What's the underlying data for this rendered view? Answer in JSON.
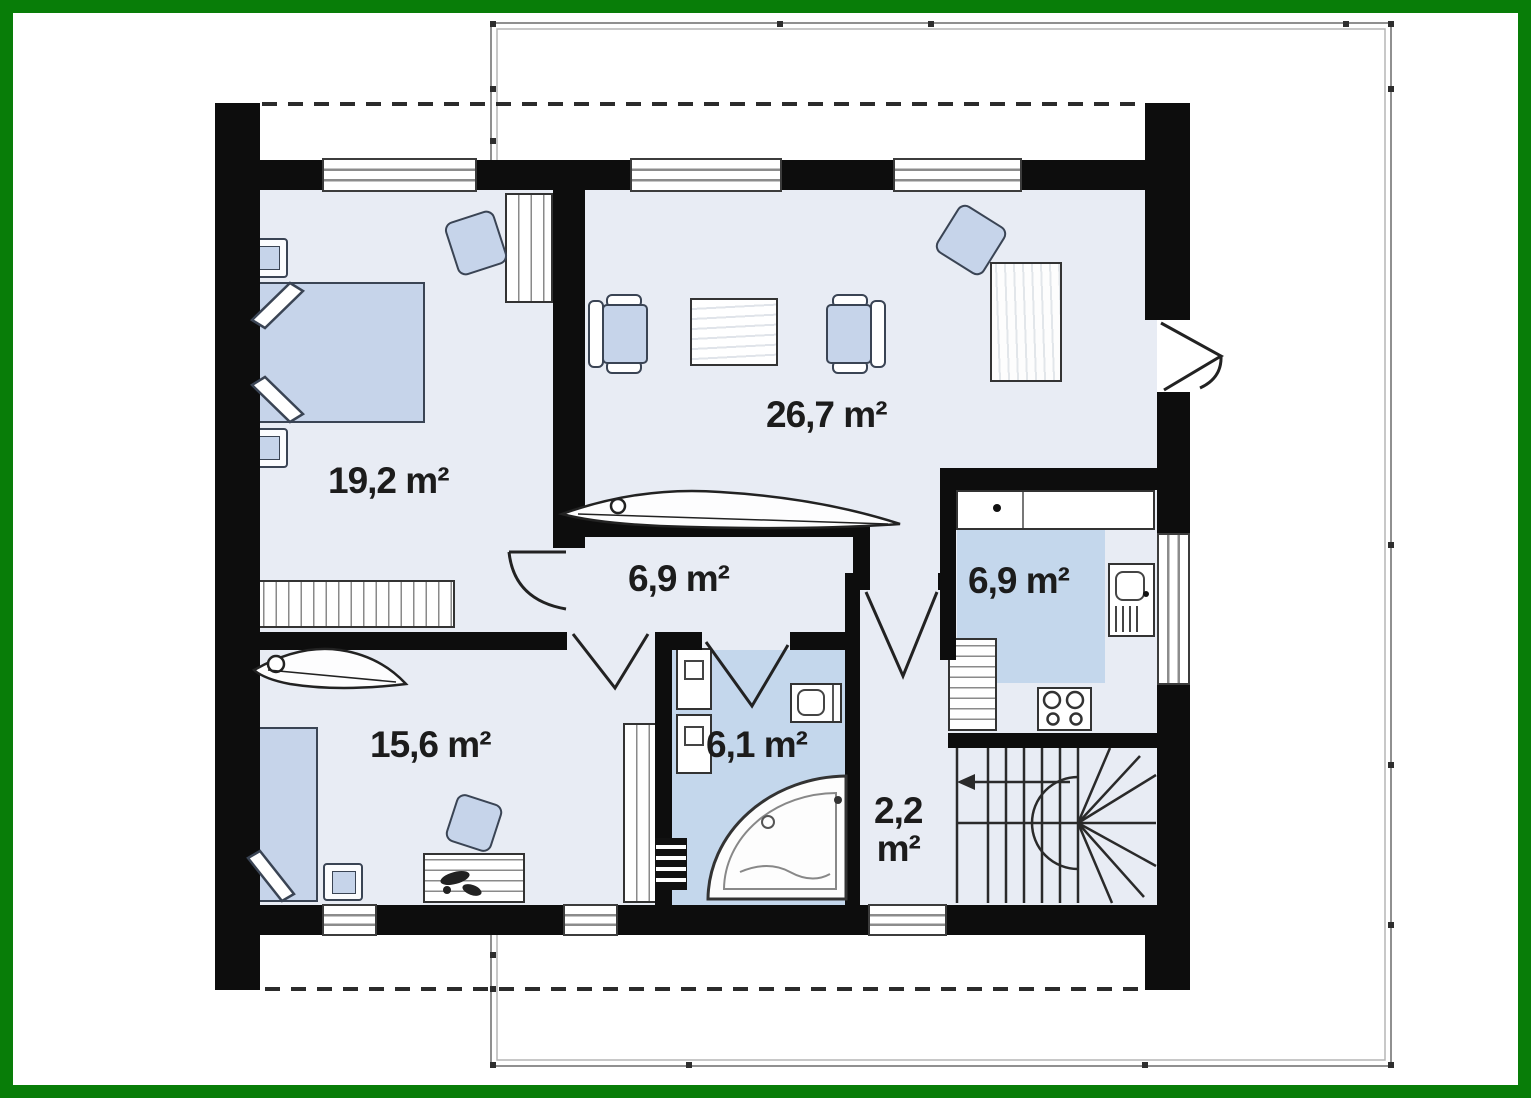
{
  "title": "first-floor plan",
  "frame": {
    "color": "#087d08"
  },
  "palette": {
    "wall": "#0d0d0d",
    "floor": "#e8ecf4",
    "wet_floor": "#c4d7ec",
    "furniture_fill": "#c6d4ea",
    "outline_stroke": "#3a4454"
  },
  "rooms": {
    "bedroom_main": {
      "area_label": "19,2 m²"
    },
    "living_room": {
      "area_label": "26,7 m²"
    },
    "hall": {
      "area_label": "6,9 m²"
    },
    "kitchen": {
      "area_label": "6,9 m²"
    },
    "bedroom_second": {
      "area_label": "15,6 m²"
    },
    "bathroom": {
      "area_label": "6,1 m²"
    },
    "vestibule": {
      "area_label_line1": "2,2",
      "area_label_line2": "m²"
    }
  }
}
